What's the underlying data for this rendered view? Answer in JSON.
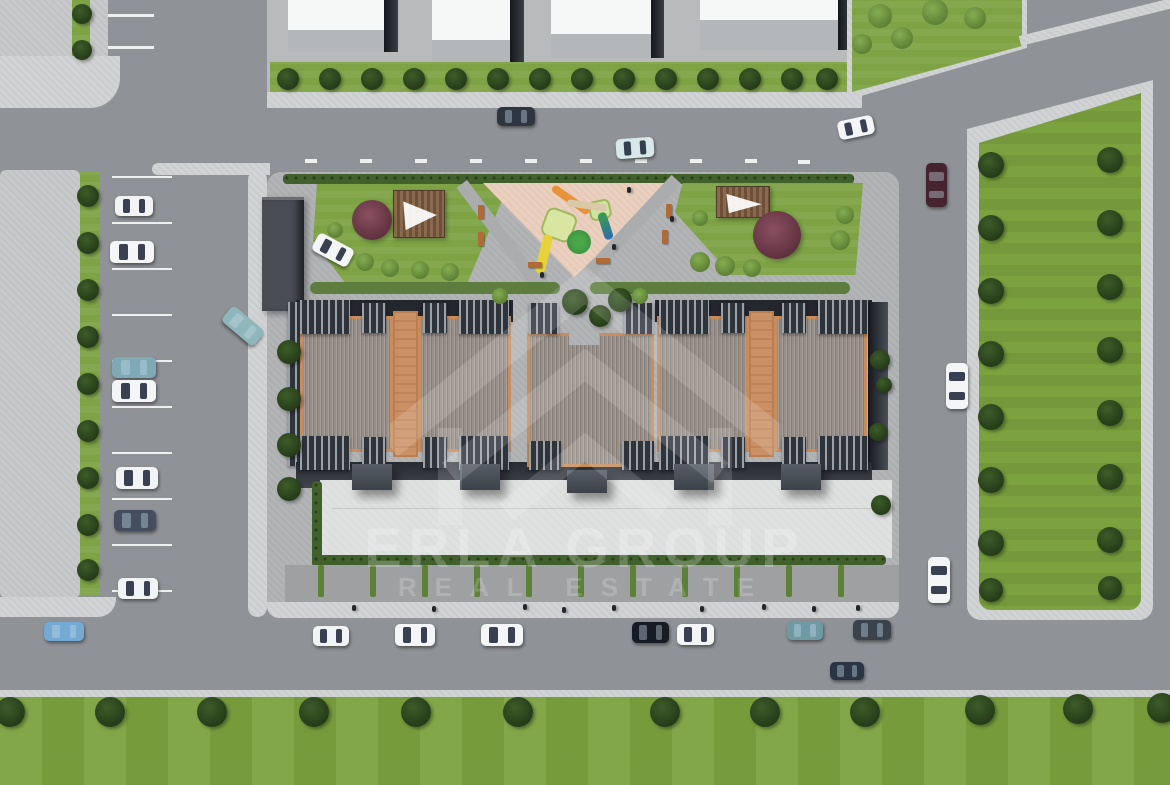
{
  "watermark": {
    "line1": "ERLA GROUP",
    "line2": "REAL ESTATE"
  },
  "palette": {
    "road": "#8f9296",
    "sidewalk": "#d1d3d4",
    "pavement": "#c7c9ca",
    "parcel_paving": "#b2b4b6",
    "grass": "#7da344",
    "tree_dark": "#2c4420",
    "roof_gray": "#978e87",
    "roof_trim_orange": "#c88d5d",
    "terrace_orange": "#cb9166",
    "balcony_slat_dark": "#2f343b",
    "plaza_concrete": "#dfe1e0",
    "hedge_green": "#40602c",
    "playground_surface": "#ecd0bf",
    "watermark_white": "#ffffff"
  },
  "scene": {
    "trees": [
      [
        82,
        14,
        10
      ],
      [
        82,
        50,
        10
      ],
      [
        288,
        79,
        11
      ],
      [
        330,
        79,
        11
      ],
      [
        372,
        79,
        11
      ],
      [
        414,
        79,
        11
      ],
      [
        456,
        79,
        11
      ],
      [
        498,
        79,
        11
      ],
      [
        540,
        79,
        11
      ],
      [
        582,
        79,
        11
      ],
      [
        624,
        79,
        11
      ],
      [
        666,
        79,
        11
      ],
      [
        708,
        79,
        11
      ],
      [
        750,
        79,
        11
      ],
      [
        792,
        79,
        11
      ],
      [
        827,
        79,
        11
      ],
      [
        88,
        196,
        11
      ],
      [
        88,
        243,
        11
      ],
      [
        88,
        290,
        11
      ],
      [
        88,
        337,
        11
      ],
      [
        88,
        384,
        11
      ],
      [
        88,
        431,
        11
      ],
      [
        88,
        478,
        11
      ],
      [
        88,
        525,
        11
      ],
      [
        88,
        570,
        11
      ],
      [
        289,
        352,
        12
      ],
      [
        289,
        399,
        12
      ],
      [
        289,
        445,
        12
      ],
      [
        289,
        489,
        12
      ],
      [
        880,
        360,
        10
      ],
      [
        884,
        385,
        8
      ],
      [
        878,
        432,
        9
      ],
      [
        881,
        505,
        10
      ],
      [
        991,
        165,
        13
      ],
      [
        991,
        228,
        13
      ],
      [
        991,
        291,
        13
      ],
      [
        991,
        354,
        13
      ],
      [
        991,
        417,
        13
      ],
      [
        991,
        480,
        13
      ],
      [
        991,
        543,
        13
      ],
      [
        991,
        590,
        12
      ],
      [
        1110,
        160,
        13
      ],
      [
        1110,
        223,
        13
      ],
      [
        1110,
        287,
        13
      ],
      [
        1110,
        350,
        13
      ],
      [
        1110,
        413,
        13
      ],
      [
        1110,
        477,
        13
      ],
      [
        1110,
        540,
        13
      ],
      [
        1110,
        588,
        12
      ],
      [
        575,
        302,
        13
      ],
      [
        600,
        316,
        11
      ],
      [
        620,
        300,
        12
      ],
      [
        10,
        712,
        15
      ],
      [
        110,
        712,
        15
      ],
      [
        212,
        712,
        15
      ],
      [
        314,
        712,
        15
      ],
      [
        416,
        712,
        15
      ],
      [
        518,
        712,
        15
      ],
      [
        665,
        712,
        15
      ],
      [
        765,
        712,
        15
      ],
      [
        865,
        712,
        15
      ],
      [
        980,
        710,
        15
      ],
      [
        1078,
        709,
        15
      ],
      [
        1162,
        708,
        15
      ]
    ],
    "bushes": [
      [
        340,
        255,
        9
      ],
      [
        365,
        262,
        9
      ],
      [
        390,
        268,
        9
      ],
      [
        420,
        270,
        9
      ],
      [
        450,
        272,
        9
      ],
      [
        335,
        230,
        8
      ],
      [
        700,
        262,
        10
      ],
      [
        725,
        266,
        10
      ],
      [
        752,
        268,
        9
      ],
      [
        700,
        218,
        8
      ],
      [
        840,
        240,
        10
      ],
      [
        845,
        215,
        9
      ],
      [
        880,
        16,
        12
      ],
      [
        935,
        12,
        13
      ],
      [
        975,
        18,
        11
      ],
      [
        902,
        38,
        11
      ],
      [
        862,
        44,
        10
      ],
      [
        500,
        296,
        8
      ],
      [
        640,
        296,
        8
      ]
    ],
    "accent_trees": [
      [
        372,
        220,
        20
      ],
      [
        777,
        235,
        24
      ]
    ],
    "cars": [
      {
        "x": 115,
        "y": 196,
        "w": 38,
        "h": 20,
        "r": 0,
        "c": "#f2f3f4"
      },
      {
        "x": 110,
        "y": 241,
        "w": 44,
        "h": 22,
        "r": 0,
        "c": "#f4f5f6"
      },
      {
        "x": 112,
        "y": 357,
        "w": 44,
        "h": 21,
        "r": 0,
        "c": "#7fa9b5"
      },
      {
        "x": 112,
        "y": 380,
        "w": 44,
        "h": 22,
        "r": 0,
        "c": "#f4f5f6"
      },
      {
        "x": 116,
        "y": 467,
        "w": 42,
        "h": 22,
        "r": 0,
        "c": "#f2f3f4"
      },
      {
        "x": 114,
        "y": 510,
        "w": 42,
        "h": 21,
        "r": 0,
        "c": "#454e5e"
      },
      {
        "x": 118,
        "y": 578,
        "w": 40,
        "h": 21,
        "r": 0,
        "c": "#f2f3f4"
      },
      {
        "x": 222,
        "y": 316,
        "w": 42,
        "h": 20,
        "r": 40,
        "c": "#8fb6ba"
      },
      {
        "x": 44,
        "y": 622,
        "w": 40,
        "h": 19,
        "r": 0,
        "c": "#74aad4"
      },
      {
        "x": 497,
        "y": 107,
        "w": 38,
        "h": 19,
        "r": 0,
        "c": "#2f3642"
      },
      {
        "x": 616,
        "y": 138,
        "w": 38,
        "h": 20,
        "r": -4,
        "c": "#d8e8e8"
      },
      {
        "x": 838,
        "y": 118,
        "w": 36,
        "h": 19,
        "r": -12,
        "c": "#f4f5f6"
      },
      {
        "x": 926,
        "y": 163,
        "w": 21,
        "h": 44,
        "r": 0,
        "c": "#45242f"
      },
      {
        "x": 946,
        "y": 363,
        "w": 22,
        "h": 46,
        "r": 0,
        "c": "#f4f5f6"
      },
      {
        "x": 928,
        "y": 557,
        "w": 22,
        "h": 46,
        "r": 0,
        "c": "#f4f5f6"
      },
      {
        "x": 313,
        "y": 626,
        "w": 36,
        "h": 20,
        "r": 0,
        "c": "#f2f3f4"
      },
      {
        "x": 395,
        "y": 624,
        "w": 40,
        "h": 22,
        "r": 0,
        "c": "#f4f5f6"
      },
      {
        "x": 481,
        "y": 624,
        "w": 42,
        "h": 22,
        "r": 0,
        "c": "#f4f5f6"
      },
      {
        "x": 632,
        "y": 622,
        "w": 37,
        "h": 21,
        "r": 0,
        "c": "#171c24"
      },
      {
        "x": 677,
        "y": 624,
        "w": 37,
        "h": 21,
        "r": 0,
        "c": "#f4f5f6"
      },
      {
        "x": 787,
        "y": 621,
        "w": 36,
        "h": 19,
        "r": 0,
        "c": "#6f9aa4"
      },
      {
        "x": 853,
        "y": 620,
        "w": 38,
        "h": 20,
        "r": 0,
        "c": "#3a424c"
      },
      {
        "x": 830,
        "y": 662,
        "w": 34,
        "h": 18,
        "r": 0,
        "c": "#2a3443"
      },
      {
        "x": 313,
        "y": 240,
        "w": 40,
        "h": 20,
        "r": 28,
        "c": "#f4f5f6"
      }
    ],
    "slats": [
      [
        300,
        300,
        50,
        34
      ],
      [
        362,
        303,
        24,
        30
      ],
      [
        423,
        303,
        24,
        30
      ],
      [
        459,
        300,
        50,
        34
      ],
      [
        300,
        436,
        50,
        34
      ],
      [
        362,
        437,
        24,
        31
      ],
      [
        423,
        437,
        24,
        31
      ],
      [
        459,
        436,
        50,
        34
      ],
      [
        659,
        300,
        50,
        34
      ],
      [
        721,
        303,
        24,
        30
      ],
      [
        782,
        303,
        24,
        30
      ],
      [
        818,
        300,
        50,
        34
      ],
      [
        659,
        436,
        50,
        34
      ],
      [
        721,
        437,
        24,
        31
      ],
      [
        782,
        437,
        24,
        31
      ],
      [
        818,
        436,
        50,
        34
      ],
      [
        529,
        303,
        30,
        31
      ],
      [
        624,
        303,
        30,
        31
      ],
      [
        529,
        441,
        32,
        29
      ],
      [
        622,
        441,
        32,
        29
      ]
    ],
    "entrances": [
      [
        352,
        464,
        40,
        26
      ],
      [
        460,
        464,
        40,
        26
      ],
      [
        567,
        470,
        40,
        23
      ],
      [
        674,
        464,
        40,
        26
      ],
      [
        781,
        464,
        40,
        26
      ]
    ],
    "dividers_y": 565,
    "dividers_x": [
      318,
      370,
      422,
      474,
      526,
      578,
      630,
      682,
      734,
      786,
      838
    ],
    "marks": [
      [
        108,
        14,
        46,
        3
      ],
      [
        108,
        46,
        46,
        3
      ],
      [
        112,
        176,
        60,
        2
      ],
      [
        112,
        222,
        60,
        2
      ],
      [
        112,
        268,
        60,
        2
      ],
      [
        112,
        314,
        60,
        2
      ],
      [
        112,
        360,
        60,
        2
      ],
      [
        112,
        406,
        60,
        2
      ],
      [
        112,
        452,
        60,
        2
      ],
      [
        112,
        498,
        60,
        2
      ],
      [
        112,
        544,
        60,
        2
      ],
      [
        112,
        590,
        60,
        2
      ],
      [
        305,
        159,
        12,
        4
      ],
      [
        360,
        159,
        12,
        4
      ],
      [
        415,
        159,
        12,
        4
      ],
      [
        470,
        159,
        12,
        4
      ],
      [
        525,
        159,
        12,
        4
      ],
      [
        580,
        159,
        12,
        4
      ],
      [
        635,
        159,
        12,
        4
      ],
      [
        690,
        159,
        12,
        4
      ],
      [
        745,
        159,
        12,
        4
      ],
      [
        798,
        160,
        12,
        4
      ]
    ],
    "pedestrians": [
      [
        352,
        605
      ],
      [
        432,
        606
      ],
      [
        523,
        604
      ],
      [
        562,
        607
      ],
      [
        612,
        605
      ],
      [
        700,
        606
      ],
      [
        762,
        604
      ],
      [
        812,
        606
      ],
      [
        856,
        605
      ],
      [
        627,
        187
      ],
      [
        612,
        244
      ],
      [
        670,
        216
      ],
      [
        540,
        272
      ]
    ],
    "benches": [
      [
        478,
        205,
        6,
        14
      ],
      [
        478,
        232,
        6,
        14
      ],
      [
        666,
        204,
        6,
        14
      ],
      [
        662,
        230,
        6,
        14
      ],
      [
        528,
        262,
        14,
        6
      ],
      [
        596,
        258,
        14,
        6
      ]
    ]
  }
}
